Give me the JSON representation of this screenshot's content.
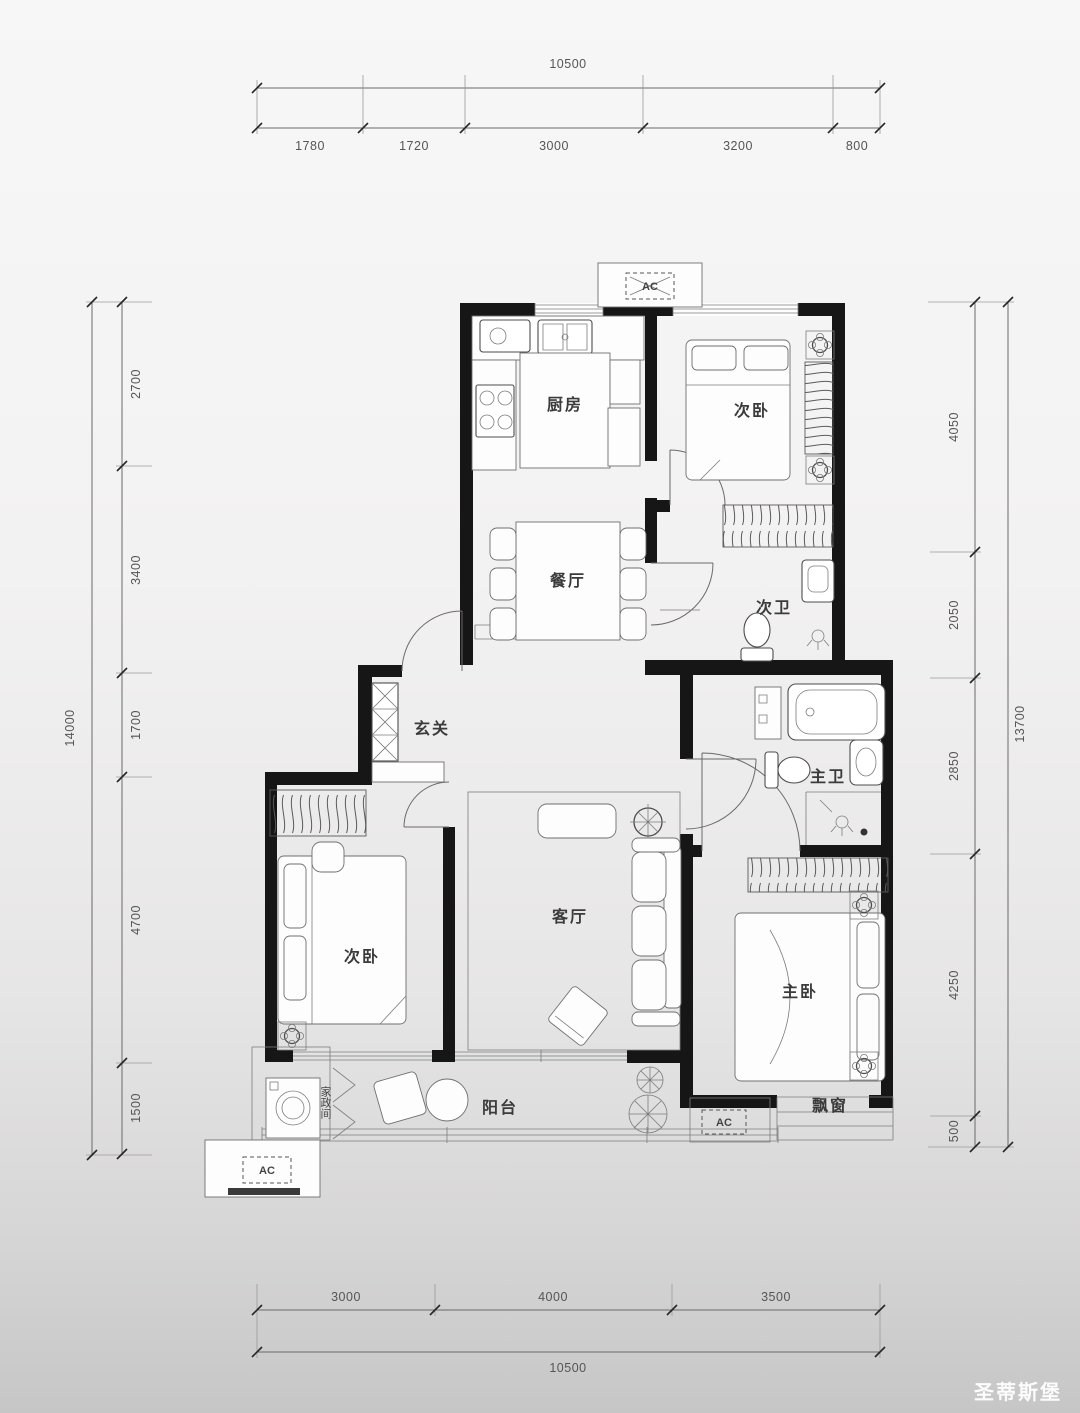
{
  "watermark": {
    "brand": "圣蒂斯堡"
  },
  "ac_unit": {
    "label": "AC"
  },
  "rooms": {
    "kitchen": "厨房",
    "bedroom_top": "次卧",
    "dining": "餐厅",
    "bath_second": "次卫",
    "foyer": "玄关",
    "living": "客厅",
    "bedroom_left": "次卧",
    "bath_master": "主卫",
    "bedroom_master": "主卧",
    "balcony": "阳台",
    "bay_window": "飘窗",
    "laundry": "家政间"
  },
  "dimensions": {
    "top": {
      "total": "10500",
      "segments": [
        "1780",
        "1720",
        "3000",
        "3200",
        "800"
      ]
    },
    "bottom": {
      "total": "10500",
      "segments": [
        "3000",
        "4000",
        "3500"
      ]
    },
    "left": {
      "total": "14000",
      "segments": [
        "2700",
        "3400",
        "1700",
        "4700",
        "1500"
      ]
    },
    "right": {
      "total": "13700",
      "segments": [
        "4050",
        "2050",
        "2850",
        "4250",
        "500"
      ]
    }
  }
}
